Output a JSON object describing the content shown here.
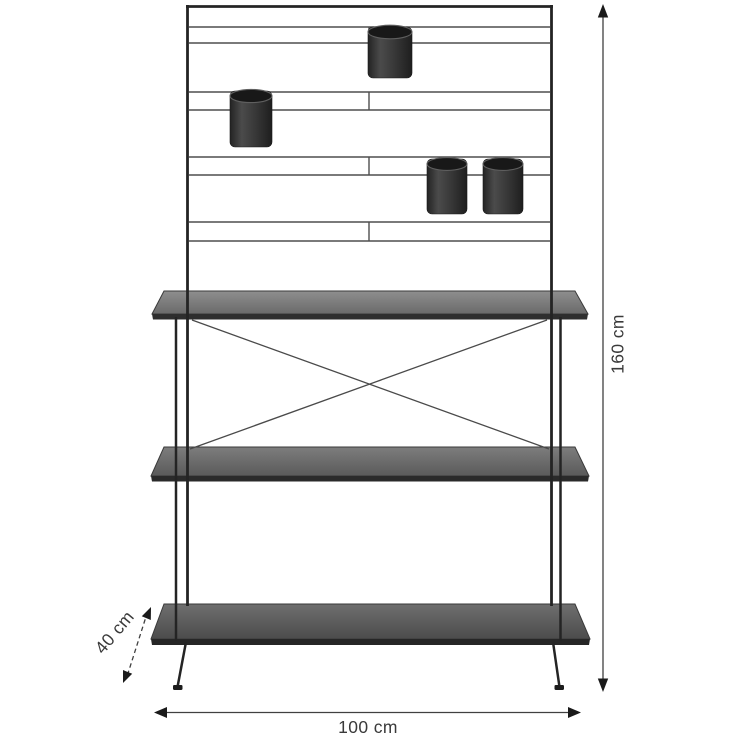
{
  "diagram": {
    "dimensions": {
      "height_label": "160 cm",
      "width_label": "100 cm",
      "depth_label": "40 cm"
    },
    "colors": {
      "background": "#ffffff",
      "frame": "#242424",
      "wire": "#4e4e4e",
      "shelf_light": "#8a8a8a",
      "shelf_dark": "#565656",
      "shelf_edge": "#2e2e2e",
      "pot_body": "#3a3a3a",
      "pot_rim": "#181818",
      "dimension_line": "#404040",
      "label_text": "#3a3a3a"
    }
  }
}
